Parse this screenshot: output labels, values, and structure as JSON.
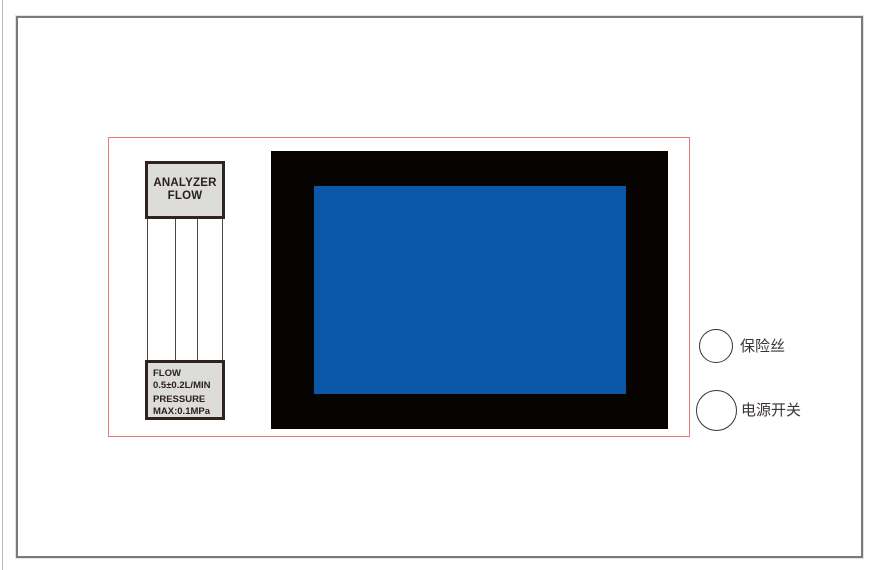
{
  "diagram": {
    "type": "instrument-front-panel-drawing",
    "flow_meter": {
      "top_label": {
        "line1": "ANALYZER",
        "line2": "FLOW"
      },
      "bottom_label": {
        "lines": [
          "FLOW",
          "0.5±0.2L/MIN",
          "PRESSURE",
          "MAX:0.1MPa"
        ]
      }
    },
    "controls": [
      {
        "id": "fuse",
        "label": "保险丝"
      },
      {
        "id": "power-switch",
        "label": "电源开关"
      }
    ]
  },
  "colors": {
    "screen_blue": "#0B57A8",
    "bezel_black": "#060300",
    "outline_red": "#EA7A7A",
    "label_fill": "#DCDCDB",
    "label_border": "#2E231E",
    "panel_border": "#7D7975",
    "tube_line": "#4C4643",
    "text_dark": "#2B211C",
    "cjk_text": "#3A3533"
  }
}
